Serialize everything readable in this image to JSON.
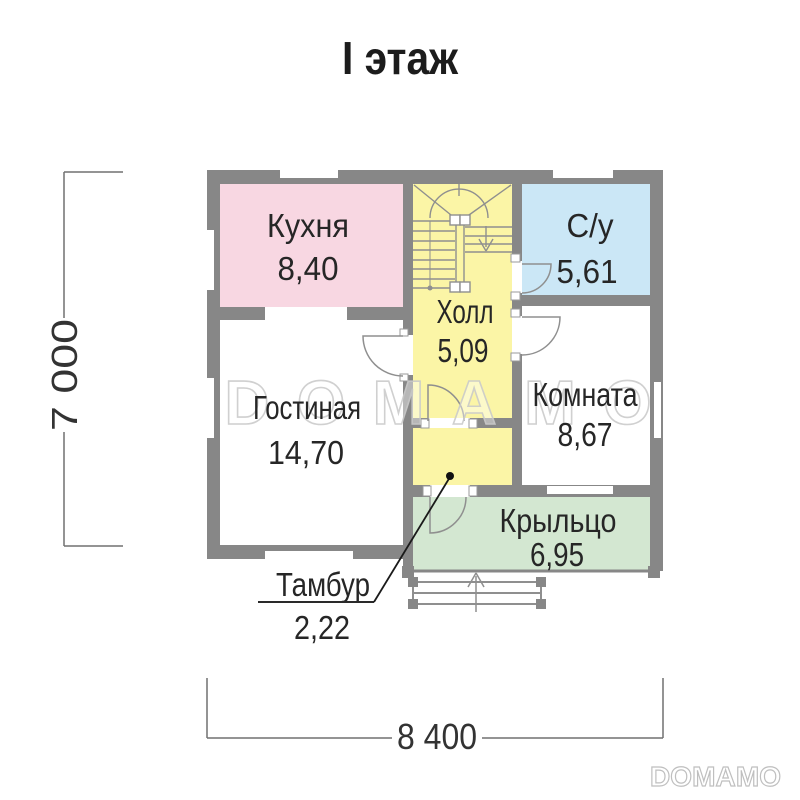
{
  "title": "I этаж",
  "rooms": {
    "kitchen": {
      "name": "Кухня",
      "area": "8,40"
    },
    "bathroom": {
      "name": "С/у",
      "area": "5,61"
    },
    "hall": {
      "name": "Холл",
      "area": "5,09"
    },
    "living_room": {
      "name": "Гостиная",
      "area": "14,70"
    },
    "room": {
      "name": "Комната",
      "area": "8,67"
    },
    "porch": {
      "name": "Крыльцо",
      "area": "6,95"
    },
    "vestibule": {
      "name": "Тамбур",
      "area": "2,22"
    }
  },
  "dimensions": {
    "total_width_mm": "8 400",
    "total_height_mm": "7 000"
  },
  "watermark": {
    "center": "DOMAMO",
    "footer": "DOMAMO"
  },
  "colors": {
    "walls": "#878787",
    "kitchen": "#f8d7e2",
    "hall": "#fbf5a6",
    "vestibule": "#fbf5a6",
    "bathroom": "#cbe7f6",
    "porch": "#d3e7d1",
    "living_room": "#ffffff",
    "room": "#ffffff"
  }
}
